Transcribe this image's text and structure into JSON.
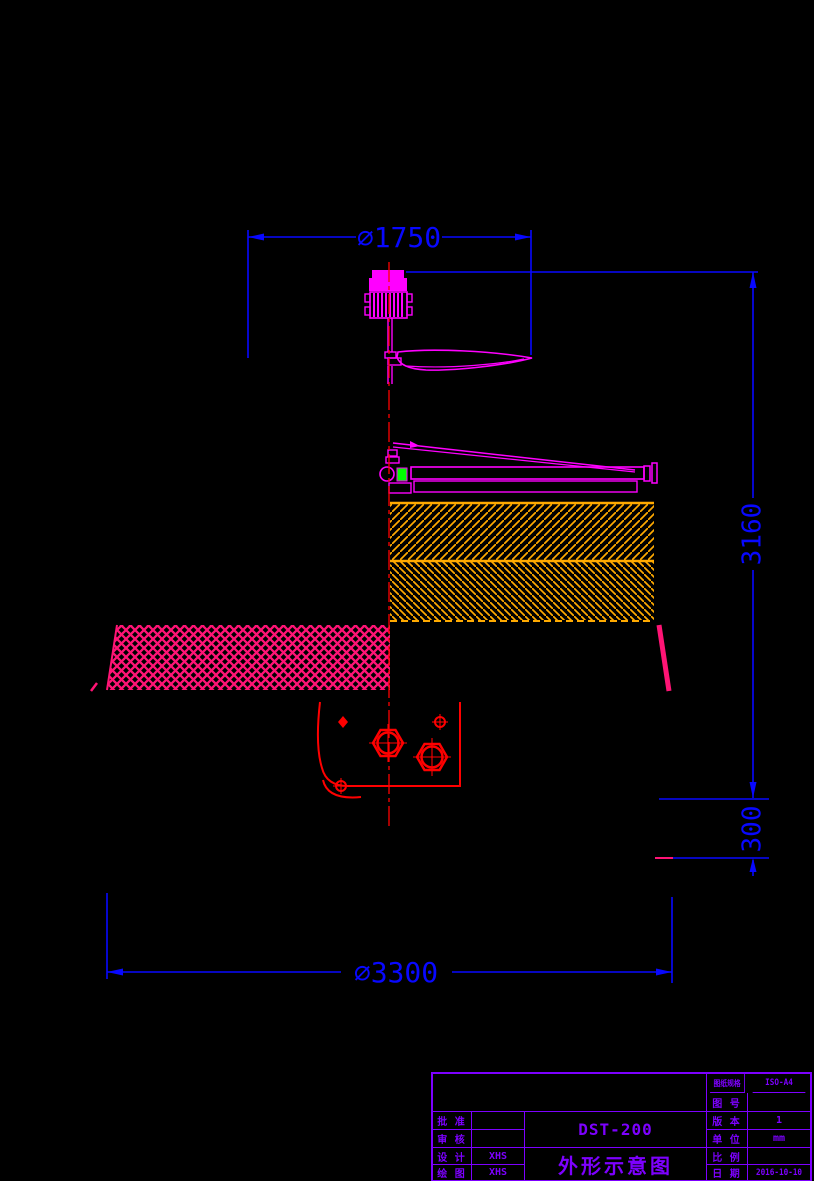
{
  "drawing": {
    "dimensions": {
      "top_diameter": "∅1750",
      "overall_height": "3160",
      "base_height": "300",
      "bottom_diameter": "∅3300"
    },
    "title_block": {
      "model": "DST-200",
      "drawing_title": "外形示意图",
      "left_rows": [
        {
          "label": "批 准",
          "value": ""
        },
        {
          "label": "审 核",
          "value": ""
        },
        {
          "label": "设 计",
          "value": "XHS"
        },
        {
          "label": "绘 图",
          "value": "XHS"
        }
      ],
      "right_rows": [
        {
          "label": "图纸规格",
          "value": "ISO-A4"
        },
        {
          "label": "图 号",
          "value": ""
        },
        {
          "label": "版 本",
          "value": "1"
        },
        {
          "label": "单 位",
          "value": "mm"
        },
        {
          "label": "比 例",
          "value": ""
        },
        {
          "label": "日 期",
          "value": "2016-10-10"
        }
      ]
    },
    "colors": {
      "dimension_blue": "#0808ff",
      "outline_magenta": "#ff00ff",
      "section_hatch_orange": "#ffaa00",
      "tank_hatch_pink": "#ff1475",
      "centerline_red": "#ff0000",
      "detail_red": "#ff0000",
      "title_block_purple": "#7d00ff",
      "bearing_green": "#00ff00",
      "background": "#000000"
    }
  }
}
